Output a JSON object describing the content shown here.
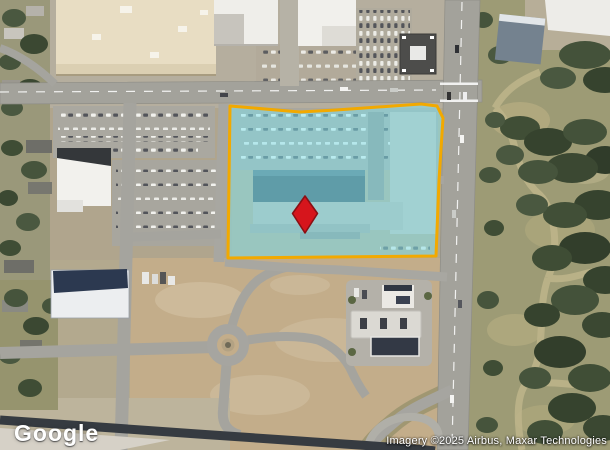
{
  "map": {
    "watermark": {
      "text": "Google"
    },
    "attribution": {
      "text": "Imagery ©2025 Airbus, Maxar Technologies"
    },
    "overlay": {
      "parcel_points": "230,106 300,112 336,110 421,104 437,106 443,118 439,180 436,256 330,257 228,258",
      "pin_points": "305,196 317.5,213.5 305,233 292.5,213.5"
    },
    "colors": {
      "parcel_border": "#F2A900",
      "parcel_fill": "#7FE3F0",
      "pin_fill": "#D6151C",
      "pin_stroke": "#8A1014",
      "watermark_color": "#FFFFFF",
      "attribution_color": "#FFFFFF"
    }
  }
}
